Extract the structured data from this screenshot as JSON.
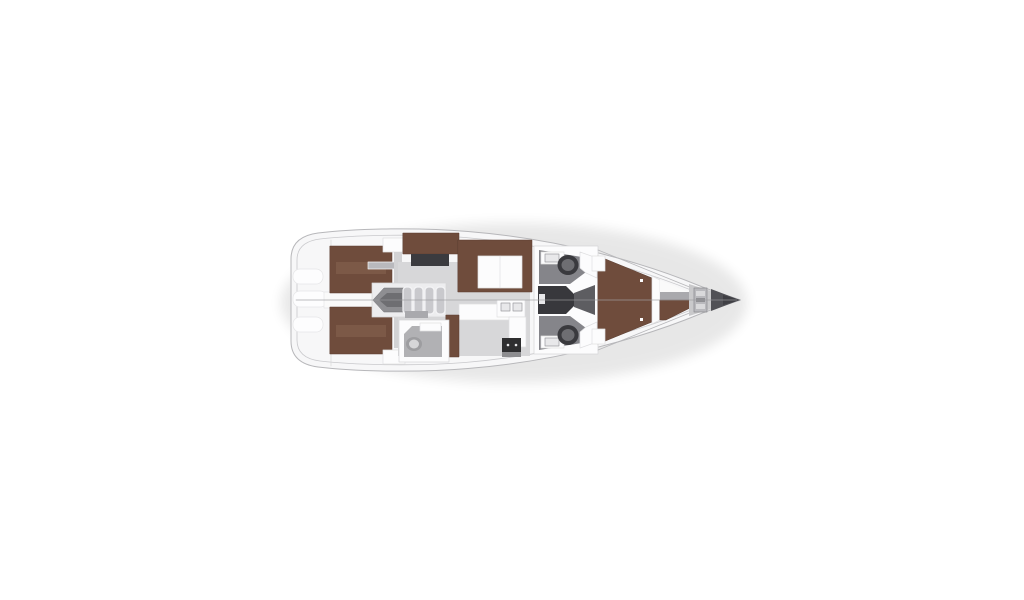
{
  "meta": {
    "title": "Sailing yacht interior floor plan, top-down view",
    "view": "top-down",
    "bow_direction": "right",
    "stern_direction": "left"
  },
  "layout": {
    "cabins": [
      "aft-port-double-berth",
      "aft-starboard-double-berth",
      "forward-v-berth"
    ],
    "heads": [
      "aft-starboard-head",
      "midship-port-head",
      "midship-starboard-head"
    ],
    "salon": [
      "u-shaped-settee",
      "folding-table",
      "nav-seat",
      "chart-table"
    ],
    "galley": [
      "l-shaped-counter",
      "double-sink",
      "stove",
      "locker"
    ],
    "other": [
      "swim-platform-steps",
      "companionway-stairs",
      "engine-hatch",
      "anchor-windlass",
      "bow-tip",
      "centerline"
    ]
  },
  "counts": {
    "transom_steps": 3,
    "stair_treads": 4,
    "toilets": 3,
    "sinks_galley": 2
  },
  "colors": {
    "background": "#ffffff",
    "shadow": "#000000",
    "hull_fill": "#f7f7f8",
    "hull_stroke": "#b7b7ba",
    "rail": "#c9c9cc",
    "wall": "#d6d6d8",
    "step_fill": "#fdfdfe",
    "step_stroke": "#e6e6e8",
    "white": "#fcfcfd",
    "white_soft": "#fafafa",
    "furniture_stroke": "#dfdfe1",
    "berth": "#6f4c3c",
    "berth_dark": "#5a3d31",
    "berth_seam": "#8a6551",
    "floor_salon": "#d7d7d9",
    "floor_cabin": "#d2d2d4",
    "floor_companionway": "#ededef",
    "floor_head_aft": "#b1b1b4",
    "floor_head_mid": "#85858a",
    "floor_bow": "#c9c9cb",
    "step_gray": "#a9a9ad",
    "passage": "#38383c",
    "vestibule": "#5d5d61",
    "chart_desk": "#3b3b3f",
    "stove": "#2e2e30",
    "stove_front": "#8d8d90",
    "tread": "#c9c9cd",
    "tread_edge": "#f4f4f6",
    "engine": "#8e8e92",
    "engine_dark": "#6e6e72",
    "toilet_rim": "#3a3a3e",
    "toilet_bowl": "#6e6e72",
    "toilet_aft_rim": "#9d9da0",
    "toilet_aft_bowl": "#d6d6d8",
    "sink": "#e8e8ea",
    "sink_stroke": "#9a9a9e",
    "windlass": "#b9b9bd",
    "windlass_stroke": "#8a8a8e",
    "windlass_light": "#d9d9db",
    "windlass_mid": "#8f8f93",
    "bow_tip": "#515156",
    "bow_tip_dark": "#3f3f44",
    "centerline": "#9b9b9e"
  }
}
